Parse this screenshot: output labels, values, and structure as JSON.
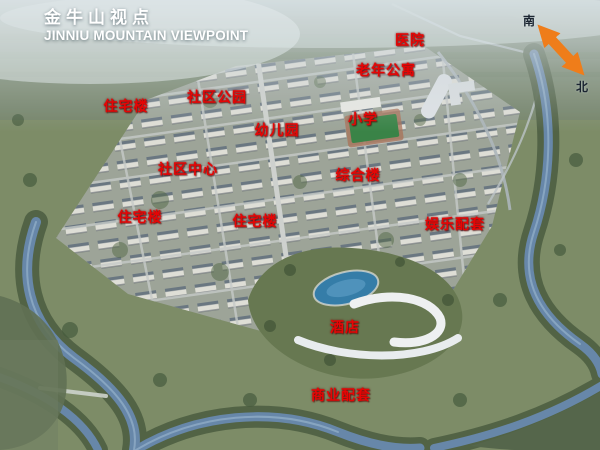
{
  "header": {
    "title_cn": "金牛山视点",
    "title_en": "JINNIU MOUNTAIN VIEWPOINT"
  },
  "compass": {
    "south_label": "南",
    "north_label": "北",
    "arrow_color": "#ef7d1a"
  },
  "colors": {
    "label_red": "#e60505",
    "title_white": "#ffffff"
  },
  "map_labels": [
    {
      "id": "hospital",
      "text": "医院",
      "x": 410,
      "y": 40
    },
    {
      "id": "senior-apartments",
      "text": "老年公寓",
      "x": 386,
      "y": 70
    },
    {
      "id": "residential-1",
      "text": "住宅楼",
      "x": 126,
      "y": 106
    },
    {
      "id": "community-park",
      "text": "社区公园",
      "x": 217,
      "y": 97
    },
    {
      "id": "kindergarten",
      "text": "幼儿园",
      "x": 277,
      "y": 130
    },
    {
      "id": "primary-school",
      "text": "小学",
      "x": 363,
      "y": 119
    },
    {
      "id": "community-center",
      "text": "社区中心",
      "x": 188,
      "y": 169
    },
    {
      "id": "mixed-use-building",
      "text": "综合楼",
      "x": 358,
      "y": 175
    },
    {
      "id": "residential-2",
      "text": "住宅楼",
      "x": 140,
      "y": 217
    },
    {
      "id": "residential-3",
      "text": "住宅楼",
      "x": 255,
      "y": 221
    },
    {
      "id": "entertainment-facilities",
      "text": "娱乐配套",
      "x": 455,
      "y": 224
    },
    {
      "id": "hotel",
      "text": "酒店",
      "x": 345,
      "y": 327
    },
    {
      "id": "commercial-facilities",
      "text": "商业配套",
      "x": 341,
      "y": 395
    }
  ]
}
